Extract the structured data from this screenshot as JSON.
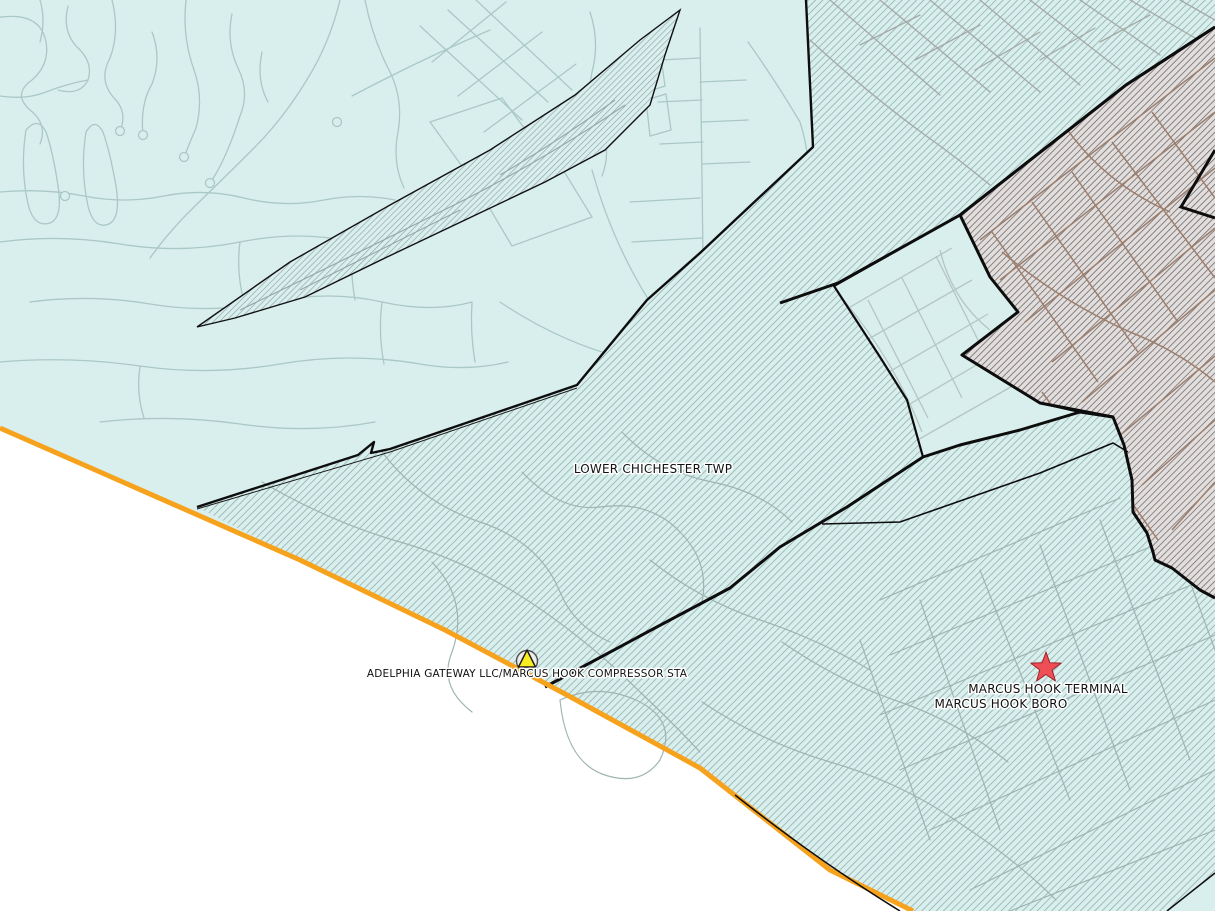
{
  "map": {
    "labels": {
      "township": "LOWER CHICHESTER TWP",
      "facility": "ADELPHIA GATEWAY LLC/MARCUS HOOK COMPRESSOR STA",
      "terminal": "MARCUS HOOK TERMINAL",
      "borough": "MARCUS HOOK BORO"
    },
    "markers": {
      "facility_marker": "triangle-in-circle",
      "terminal_marker": "star"
    },
    "colors": {
      "land": "#d9efed",
      "outside": "#ffffff",
      "state_line": "#f6a21d",
      "boundary": "#0d0d0d",
      "hatch_teal_line": "#9dbab7",
      "hatch_slate_line": "#8fa2a8",
      "district_bg": "#e1dedd",
      "district_hatch_line": "#6e6765",
      "road_primary": "#aac8c6",
      "road_brown": "#9c7e6d",
      "star_fill": "#ee4f57",
      "triangle_fill": "#f8ee20"
    }
  }
}
